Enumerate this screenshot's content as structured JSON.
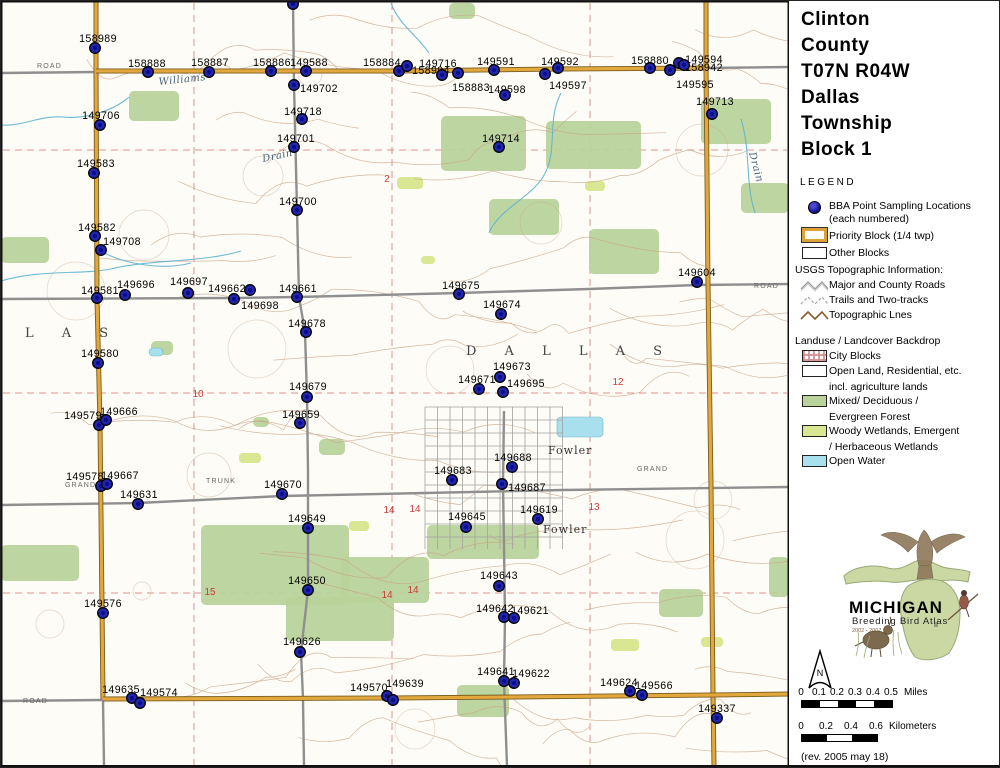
{
  "colors": {
    "paper": "#fdfcf6",
    "dot_fill": "#2226ab",
    "dot_core": "#000080",
    "dot_stroke": "#000000",
    "road_gray": "#8f8f8f",
    "road_orange": "#e2a83d",
    "road_orange_edge": "#7a5c1e",
    "forest": "#b9d39b",
    "wetland": "#d9e792",
    "water": "#a8e0ee",
    "stream": "#5fb3d1",
    "contour": "#c8a185",
    "red_section": "#cc3a3a",
    "city_grid": "#a2a2a2",
    "map_border": "#111111"
  },
  "panel": {
    "title_lines": [
      "Clinton",
      "County",
      "T07N R04W",
      "Dallas",
      "Township",
      "Block 1"
    ],
    "legend_heading": "LEGEND",
    "legend": {
      "bba_label_1": "BBA Point Sampling Locations",
      "bba_label_2": "(each numbered)",
      "priority_block": "Priority Block (1/4 twp)",
      "other_blocks": "Other Blocks",
      "usgs_heading": "USGS Topographic Information:",
      "roads": "Major and County Roads",
      "trails": "Trails and Two-tracks",
      "topo_lines": "Topographic Lnes",
      "landuse_heading": "Landuse / Landcover Backdrop",
      "city_blocks": "City Blocks",
      "open_land_1": "Open Land, Residential, etc.",
      "open_land_2": "incl. agriculture lands",
      "forest_1": "Mixed/ Deciduous /",
      "forest_2": "Evergreen Forest",
      "wetland_1": "Woody Wetlands, Emergent",
      "wetland_2": "/ Herbaceous Wetlands",
      "open_water": "Open Water"
    },
    "logo": {
      "name": "MICHIGAN",
      "subtitle": "Breeding Bird Atlas",
      "edition": "II",
      "years": "2002 - 2007"
    },
    "north_label": "N",
    "scale_miles": {
      "ticks": [
        "0",
        "0.1",
        "0.2",
        "0.3",
        "0.4",
        "0.5"
      ],
      "unit": "Miles"
    },
    "scale_km": {
      "ticks": [
        "0",
        "0.2",
        "0.4",
        "0.6"
      ],
      "unit": "Kilometers"
    },
    "revision": "(rev. 2005 may 18)"
  },
  "map": {
    "points_format": [
      "label",
      "label_cx",
      "label_cy",
      "dot_cx",
      "dot_cy"
    ],
    "points": [
      [
        "158989",
        97,
        37,
        94,
        47
      ],
      [
        "158888",
        146,
        62,
        147,
        71
      ],
      [
        "158887",
        209,
        61,
        208,
        71
      ],
      [
        "158886",
        271,
        61,
        270,
        70
      ],
      [
        "149588",
        308,
        61,
        305,
        70
      ],
      [
        "158884",
        381,
        61,
        398,
        70
      ],
      [
        "149716",
        437,
        62,
        457,
        72
      ],
      [
        "158994",
        430,
        69,
        441,
        74
      ],
      [
        "158883",
        470,
        86,
        406,
        65
      ],
      [
        "149591",
        495,
        60,
        493,
        69
      ],
      [
        "149598",
        506,
        88,
        504,
        94
      ],
      [
        "149597",
        567,
        84,
        544,
        73
      ],
      [
        "149592",
        559,
        60,
        557,
        67
      ],
      [
        "158880",
        649,
        59,
        649,
        67
      ],
      [
        "149594",
        703,
        58,
        678,
        62
      ],
      [
        "158942",
        703,
        66,
        683,
        64
      ],
      [
        "149595",
        694,
        83,
        669,
        69
      ],
      [
        "149713",
        714,
        100,
        711,
        113
      ],
      [
        "149702",
        318,
        87,
        293,
        84
      ],
      [
        "149718",
        302,
        110,
        301,
        118
      ],
      [
        "149701",
        295,
        137,
        293,
        146
      ],
      [
        "149706",
        100,
        114,
        99,
        124
      ],
      [
        "149714",
        500,
        137,
        498,
        146
      ],
      [
        "149583",
        95,
        162,
        93,
        172
      ],
      [
        "149700",
        297,
        200,
        296,
        209
      ],
      [
        "149582",
        96,
        226,
        94,
        235
      ],
      [
        "149708",
        121,
        240,
        100,
        249
      ],
      [
        "149604",
        696,
        271,
        696,
        281
      ],
      [
        "149581",
        99,
        289,
        96,
        297
      ],
      [
        "149696",
        135,
        283,
        124,
        294
      ],
      [
        "149697",
        188,
        280,
        187,
        292
      ],
      [
        "149662",
        226,
        287,
        249,
        289
      ],
      [
        "149698",
        259,
        304,
        233,
        298
      ],
      [
        "149661",
        297,
        287,
        296,
        296
      ],
      [
        "149675",
        460,
        284,
        458,
        293
      ],
      [
        "149674",
        501,
        303,
        500,
        313
      ],
      [
        "149678",
        306,
        322,
        305,
        331
      ],
      [
        "149580",
        99,
        352,
        97,
        362
      ],
      [
        "149673",
        511,
        365,
        499,
        376
      ],
      [
        "149671",
        476,
        378,
        478,
        388
      ],
      [
        "149695",
        525,
        382,
        502,
        391
      ],
      [
        "149679",
        307,
        385,
        306,
        396
      ],
      [
        "149579",
        82,
        414,
        98,
        424
      ],
      [
        "149666",
        118,
        410,
        105,
        419
      ],
      [
        "149659",
        300,
        413,
        299,
        422
      ],
      [
        "149578",
        84,
        475,
        100,
        485
      ],
      [
        "149667",
        119,
        474,
        106,
        483
      ],
      [
        "149631",
        138,
        493,
        137,
        503
      ],
      [
        "149670",
        282,
        483,
        281,
        493
      ],
      [
        "149688",
        512,
        456,
        511,
        466
      ],
      [
        "149683",
        452,
        469,
        451,
        479
      ],
      [
        "149687",
        526,
        486,
        501,
        483
      ],
      [
        "149649",
        306,
        517,
        307,
        527
      ],
      [
        "149645",
        466,
        515,
        465,
        526
      ],
      [
        "149619",
        538,
        508,
        537,
        518
      ],
      [
        "149650",
        306,
        579,
        307,
        589
      ],
      [
        "149643",
        498,
        574,
        498,
        585
      ],
      [
        "149576",
        102,
        602,
        102,
        612
      ],
      [
        "149642",
        494,
        607,
        503,
        616
      ],
      [
        "149621",
        529,
        609,
        513,
        617
      ],
      [
        "149626",
        301,
        640,
        299,
        651
      ],
      [
        "149635",
        120,
        688,
        131,
        697
      ],
      [
        "149574",
        158,
        691,
        139,
        702
      ],
      [
        "149570",
        368,
        686,
        386,
        695
      ],
      [
        "149639",
        404,
        682,
        392,
        699
      ],
      [
        "149641",
        495,
        670,
        503,
        680
      ],
      [
        "149622",
        530,
        672,
        513,
        682
      ],
      [
        "149624",
        618,
        681,
        629,
        690
      ],
      [
        "149566",
        653,
        684,
        641,
        694
      ],
      [
        "149337",
        716,
        707,
        716,
        717
      ],
      [
        "",
        0,
        0,
        292,
        3
      ]
    ],
    "place_labels": [
      {
        "t": "Williams",
        "x": 158,
        "y": 84,
        "r": -6,
        "s": "stream"
      },
      {
        "t": "Drain",
        "x": 262,
        "y": 161,
        "r": -12,
        "s": "stream"
      },
      {
        "t": "Drain",
        "x": 748,
        "y": 152,
        "r": 75,
        "s": "stream"
      },
      {
        "t": "D A L L A S",
        "x": 465,
        "y": 354,
        "r": 0,
        "s": "townbig"
      },
      {
        "t": "L A S",
        "x": 24,
        "y": 336,
        "r": 0,
        "s": "townbig"
      },
      {
        "t": "Fowler",
        "x": 547,
        "y": 453,
        "r": 0,
        "s": "town"
      },
      {
        "t": "Fowler",
        "x": 542,
        "y": 532,
        "r": 0,
        "s": "town"
      },
      {
        "t": "GRAND",
        "x": 64,
        "y": 486,
        "r": 0,
        "s": "road"
      },
      {
        "t": "TRUNK",
        "x": 205,
        "y": 482,
        "r": 0,
        "s": "road"
      },
      {
        "t": "GRAND",
        "x": 636,
        "y": 470,
        "r": 0,
        "s": "road"
      },
      {
        "t": "ROAD",
        "x": 36,
        "y": 67,
        "r": 0,
        "s": "road"
      },
      {
        "t": "ROAD",
        "x": 753,
        "y": 287,
        "r": 0,
        "s": "road"
      },
      {
        "t": "ROAD",
        "x": 22,
        "y": 702,
        "r": 0,
        "s": "road"
      }
    ],
    "section_numbers": [
      {
        "t": "2",
        "x": 386,
        "y": 181
      },
      {
        "t": "10",
        "x": 197,
        "y": 396
      },
      {
        "t": "12",
        "x": 617,
        "y": 384
      },
      {
        "t": "13",
        "x": 593,
        "y": 509
      },
      {
        "t": "14",
        "x": 388,
        "y": 512
      },
      {
        "t": "14",
        "x": 414,
        "y": 511
      },
      {
        "t": "15",
        "x": 209,
        "y": 594
      },
      {
        "t": "14",
        "x": 386,
        "y": 597
      },
      {
        "t": "14",
        "x": 412,
        "y": 592
      }
    ],
    "roads_gray": [
      [
        [
          0,
          72
        ],
        [
          95,
          71
        ],
        [
          398,
          70
        ],
        [
          557,
          68
        ],
        [
          705,
          67
        ],
        [
          788,
          66
        ]
      ],
      [
        [
          0,
          298
        ],
        [
          233,
          297
        ],
        [
          296,
          296
        ],
        [
          458,
          292
        ],
        [
          588,
          288
        ],
        [
          696,
          284
        ],
        [
          788,
          283
        ]
      ],
      [
        [
          0,
          504
        ],
        [
          137,
          502
        ],
        [
          281,
          495
        ],
        [
          424,
          492
        ],
        [
          562,
          489
        ],
        [
          788,
          486
        ]
      ],
      [
        [
          292,
          0
        ],
        [
          293,
          84
        ],
        [
          296,
          209
        ],
        [
          298,
          296
        ],
        [
          304,
          331
        ],
        [
          306,
          396
        ],
        [
          307,
          470
        ],
        [
          307,
          527
        ],
        [
          307,
          589
        ],
        [
          300,
          651
        ],
        [
          302,
          698
        ],
        [
          303,
          765
        ]
      ],
      [
        [
          503,
          410
        ],
        [
          502,
          483
        ],
        [
          503,
          545
        ],
        [
          504,
          616
        ],
        [
          503,
          680
        ],
        [
          506,
          765
        ]
      ],
      [
        [
          0,
          700
        ],
        [
          102,
          699
        ]
      ],
      [
        [
          102,
          698
        ],
        [
          103,
          765
        ]
      ]
    ],
    "roads_orange": [
      [
        [
          95,
          0
        ],
        [
          95,
          70
        ],
        [
          96,
          297
        ],
        [
          99,
          424
        ],
        [
          102,
          698
        ]
      ],
      [
        [
          95,
          70
        ],
        [
          398,
          70
        ],
        [
          557,
          68
        ],
        [
          705,
          67
        ]
      ],
      [
        [
          705,
          0
        ],
        [
          705,
          67
        ],
        [
          707,
          284
        ],
        [
          710,
          486
        ],
        [
          712,
          694
        ],
        [
          713,
          765
        ]
      ],
      [
        [
          102,
          698
        ],
        [
          390,
          697
        ],
        [
          513,
          696
        ],
        [
          712,
          694
        ],
        [
          788,
          693
        ]
      ]
    ],
    "red_section_lines": {
      "vertical_x": [
        193,
        391,
        589
      ],
      "horizontal_y": [
        149,
        392,
        592
      ]
    },
    "forest": [
      [
        128,
        90,
        50,
        30
      ],
      [
        448,
        2,
        26,
        16
      ],
      [
        440,
        115,
        85,
        55
      ],
      [
        545,
        120,
        95,
        48
      ],
      [
        700,
        98,
        70,
        45
      ],
      [
        0,
        236,
        48,
        26
      ],
      [
        150,
        340,
        22,
        14
      ],
      [
        488,
        198,
        70,
        36
      ],
      [
        588,
        228,
        70,
        45
      ],
      [
        740,
        182,
        48,
        30
      ],
      [
        318,
        438,
        26,
        16
      ],
      [
        252,
        416,
        16,
        10
      ],
      [
        200,
        524,
        148,
        80
      ],
      [
        340,
        556,
        88,
        46
      ],
      [
        426,
        524,
        112,
        34
      ],
      [
        0,
        544,
        78,
        36
      ],
      [
        285,
        596,
        108,
        44
      ],
      [
        658,
        588,
        44,
        28
      ],
      [
        768,
        556,
        20,
        40
      ],
      [
        456,
        684,
        52,
        32
      ]
    ],
    "wetlands": [
      [
        396,
        176,
        26,
        12
      ],
      [
        584,
        180,
        20,
        10
      ],
      [
        238,
        452,
        22,
        10
      ],
      [
        610,
        638,
        28,
        12
      ],
      [
        700,
        636,
        22,
        10
      ],
      [
        420,
        255,
        14,
        8
      ],
      [
        348,
        520,
        20,
        10
      ]
    ],
    "water": [
      [
        556,
        416,
        46,
        20
      ],
      [
        148,
        347,
        14,
        8
      ]
    ],
    "streams": [
      "M128,96 C110,112 80,118 62,116 C40,114 20,126 0,124",
      "M240,250 C200,262 150,258 110,268 C80,274 40,268 0,280",
      "M560,92 C545,120 558,150 542,176 C528,198 498,208 488,232",
      "M390,2 C398,24 416,34 428,52",
      "M100,250 C120,262 160,270 190,262",
      "M740,118 C750,150 744,182 754,212"
    ],
    "city_area": {
      "x": 424,
      "y": 406,
      "w": 138,
      "h": 142
    }
  }
}
